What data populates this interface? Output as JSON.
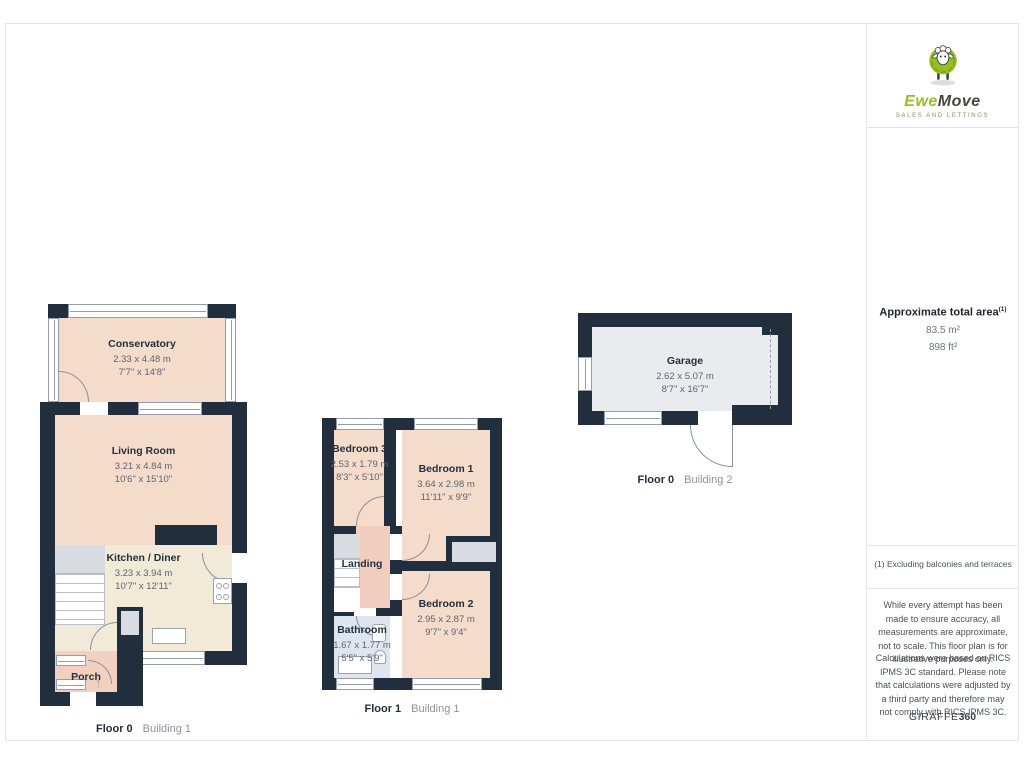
{
  "branding": {
    "logo": {
      "brand_part1": "Ewe",
      "brand_part2": "Move",
      "tagline": "SALES AND LETTINGS"
    },
    "footer_brand": {
      "part1": "GIRAFFE",
      "part2": "360"
    }
  },
  "summary": {
    "title": "Approximate total area",
    "title_superscript": "(1)",
    "area_m2": "83.5 m²",
    "area_ft2": "898 ft²",
    "footnote": "(1) Excluding balconies and terraces",
    "disclaimer_accuracy": "While every attempt has been made to ensure accuracy, all measurements are approximate, not to scale. This floor plan is for illustrative purposes only.",
    "disclaimer_calculations": "Calculations were based on RICS IPMS 3C standard. Please note that calculations were adjusted by a third party and therefore may not comply with RICS IPMS 3C."
  },
  "plans": {
    "b1f0": {
      "floor": "Floor 0",
      "building": "Building 1",
      "conservatory": {
        "name": "Conservatory",
        "m": "2.33 x 4.48 m",
        "ft": "7'7\" x 14'8\""
      },
      "living": {
        "name": "Living Room",
        "m": "3.21 x 4.84 m",
        "ft": "10'6\" x 15'10\""
      },
      "kitchen": {
        "name": "Kitchen / Diner",
        "m": "3.23 x 3.94 m",
        "ft": "10'7\" x 12'11\""
      },
      "porch": {
        "name": "Porch"
      }
    },
    "b1f1": {
      "floor": "Floor 1",
      "building": "Building 1",
      "bedroom3": {
        "name": "Bedroom 3",
        "m": "2.53 x 1.79 m",
        "ft": "8'3\" x 5'10\""
      },
      "bedroom1": {
        "name": "Bedroom 1",
        "m": "3.64 x 2.98 m",
        "ft": "11'11\" x 9'9\""
      },
      "landing": {
        "name": "Landing"
      },
      "bathroom": {
        "name": "Bathroom",
        "m": "1.67 x 1.77 m",
        "ft": "5'5\" x 5'9\""
      },
      "bedroom2": {
        "name": "Bedroom 2",
        "m": "2.95 x 2.87 m",
        "ft": "9'7\" x 9'4\""
      }
    },
    "b2f0": {
      "floor": "Floor 0",
      "building": "Building 2",
      "garage": {
        "name": "Garage",
        "m": "2.62 x 5.07 m",
        "ft": "8'7\" x 16'7\""
      }
    }
  },
  "icons": {
    "entrance_arrow": "↑"
  },
  "colors": {
    "wall": "#212e3e",
    "room_peach": "#f5dbca",
    "kitchen_cream": "#f0ead6",
    "landing_salmon": "#f0cdbc",
    "porch_salmon": "#f2d0c0",
    "bathroom_blue": "#dfe5ee",
    "garage_grey": "#e9ebee",
    "brand_green": "#95c11f"
  }
}
